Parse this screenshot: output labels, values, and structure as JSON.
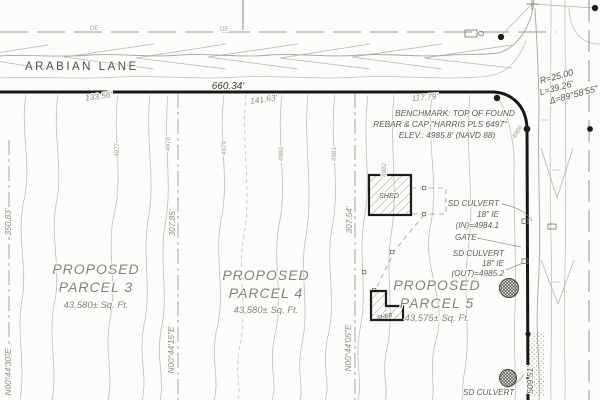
{
  "road": {
    "name": "ARABIAN LANE",
    "oe_labels": [
      "OE",
      "OE"
    ]
  },
  "boundary": {
    "north_dim": "660.34'",
    "segments": [
      "133.56'",
      "141.63'",
      "117.79'"
    ],
    "east_dim": "509.51'",
    "curve": {
      "radius": "R=25.00",
      "length": "L=39.26'",
      "delta": "Δ=89°58'55\""
    }
  },
  "benchmark": {
    "line1": "BENCHMARK: TOP OF FOUND",
    "line2": "REBAR & CAP \"HARRIS PLS 6497\"",
    "line3": "ELEV.: 4985.8' (NAVD 88)"
  },
  "parcels": [
    {
      "label1": "PROPOSED",
      "label2": "PARCEL 3",
      "area": "43,580± Sq. Ft."
    },
    {
      "label1": "PROPOSED",
      "label2": "PARCEL 4",
      "area": "43,580± Sq. Ft."
    },
    {
      "label1": "PROPOSED",
      "label2": "PARCEL 5",
      "area": "43,575± Sq. Ft."
    }
  ],
  "lot_lines": {
    "west": {
      "dim": "350.83'",
      "bearing": "N00°44'30\"E"
    },
    "mid_west": {
      "dim": "307.85'",
      "bearing": "N00°44'15\"E"
    },
    "mid_east": {
      "dim": "307.54'",
      "bearing": "N00°44'05\"E"
    }
  },
  "features": {
    "shed_large": "SHED",
    "shed_small": "SHED",
    "gate": "GATE",
    "culvert_in": [
      "SD CULVERT",
      "18\" IE",
      "(IN)=4984.1"
    ],
    "culvert_out": [
      "SD CULVERT",
      "18\" IE",
      "(OUT)=4985.2"
    ],
    "culvert_south": "SD CULVERT"
  },
  "contour_labels": [
    "4977",
    "4978",
    "4979",
    "4980",
    "4981",
    "4982",
    "4986"
  ]
}
